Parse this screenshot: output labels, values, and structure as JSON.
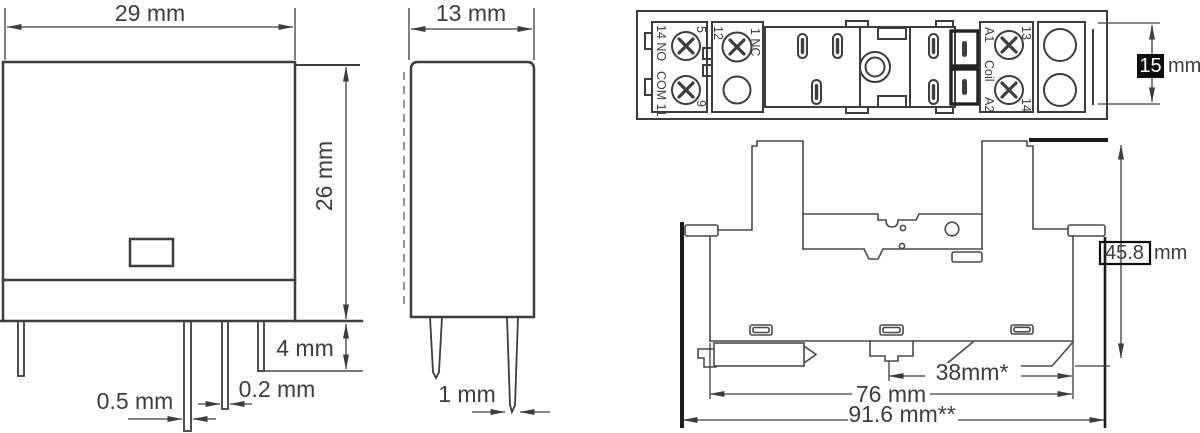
{
  "palette": {
    "ink": "#3d3d3d",
    "dark": "#1b1b1b",
    "background": "#ffffff",
    "highlight_box": "#0d0d0d"
  },
  "relay_front": {
    "width_dim": "29 mm",
    "height_dim": "26 mm",
    "pin_length_dim": "4 mm",
    "pin_thickness_dim": "0.5 mm",
    "pin_width_dim": "0.2 mm"
  },
  "relay_side": {
    "width_dim": "13 mm",
    "pin_dim": "1 mm"
  },
  "socket_top": {
    "terminals": {
      "no14": "14 NO",
      "com11": "COM 11",
      "t5": "5",
      "t9": "9",
      "t12": "12",
      "nc1": "1 NC",
      "a1": "A1",
      "coil": "Coil",
      "a2": "A2",
      "t13": "13",
      "t14": "14"
    },
    "height_value": "15",
    "height_unit": "mm"
  },
  "socket_side": {
    "pitch_dim": "38mm*",
    "body_width_dim": "76 mm",
    "overall_width_dim": "91.6 mm**",
    "height_value": "45.8",
    "height_unit": "mm"
  }
}
